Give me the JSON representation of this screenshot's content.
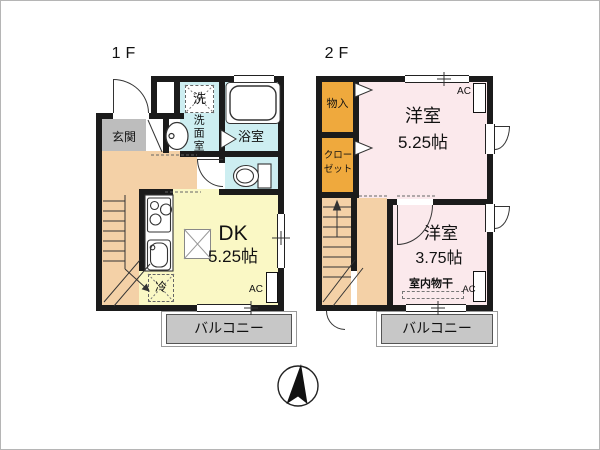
{
  "colors": {
    "walls": "#1b1b1b",
    "entrance": "#bdbdbd",
    "hallway": "#f4d1a7",
    "dk": "#faf8c5",
    "wet": "#cdeef1",
    "western": "#fbe9ec",
    "closet": "#efa93d",
    "balcony": "#c7c7c7"
  },
  "floor1": {
    "label": "1F",
    "entrance": "玄関",
    "washer": "洗",
    "washroom": "洗面室",
    "bathroom": "浴室",
    "dk_label": "DK",
    "dk_size": "5.25帖",
    "fridge": "冷",
    "ac": "AC",
    "balcony": "バルコニー"
  },
  "floor2": {
    "label": "2F",
    "storage": "物入",
    "closet_line1": "クロー",
    "closet_line2": "ゼット",
    "room1_label": "洋室",
    "room1_size": "5.25帖",
    "ac_room1": "AC",
    "room2_label": "洋室",
    "room2_size": "3.75帖",
    "indoor_drying": "室内物干",
    "ac_room2": "AC",
    "balcony": "バルコニー"
  },
  "compass": {
    "type": "north-arrow"
  }
}
